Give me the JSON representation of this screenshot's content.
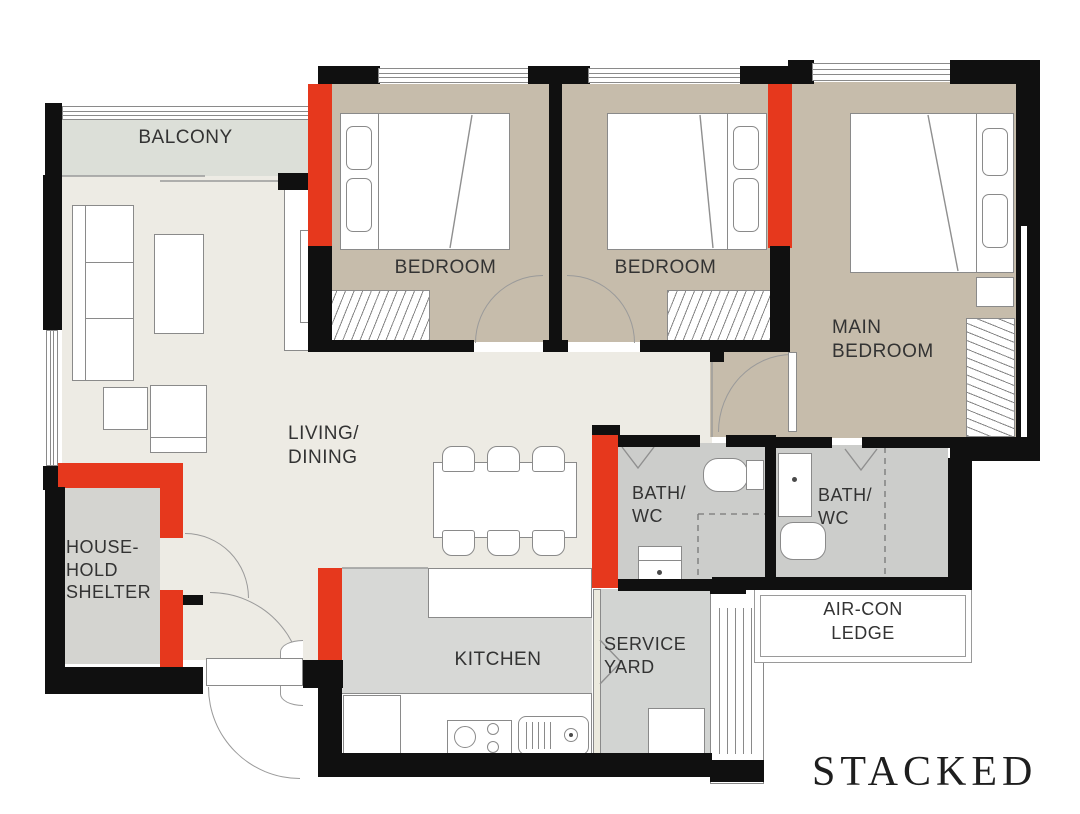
{
  "palette": {
    "wall_black": "#101010",
    "structural_red": "#e6381d",
    "bedroom_beige": "#c6bcab",
    "living_cream": "#edebe4",
    "balcony_gray_green": "#dcdfd8",
    "kitchen_gray": "#d7d8d6",
    "bath_gray": "#cccdcb",
    "shelter_gray": "#d4d4d0",
    "service_gray": "#d2d4d2",
    "furniture_outline": "#8a8a8a",
    "label_color": "#333333"
  },
  "rooms": {
    "balcony": {
      "label": "BALCONY"
    },
    "bedroom_1": {
      "label": "BEDROOM"
    },
    "bedroom_2": {
      "label": "BEDROOM"
    },
    "main_bedroom": {
      "line1": "MAIN",
      "line2": "BEDROOM"
    },
    "living_dining": {
      "line1": "LIVING/",
      "line2": "DINING"
    },
    "household_shelter": {
      "line1": "HOUSE-",
      "line2": "HOLD",
      "line3": "SHELTER"
    },
    "bath_1": {
      "line1": "BATH/",
      "line2": "WC"
    },
    "bath_2": {
      "line1": "BATH/",
      "line2": "WC"
    },
    "kitchen": {
      "label": "KITCHEN"
    },
    "service_yard": {
      "line1": "SERVICE",
      "line2": "YARD"
    },
    "aircon_ledge": {
      "line1": "AIR-CON",
      "line2": "LEDGE"
    }
  },
  "branding": {
    "logo_text": "STACKED"
  }
}
